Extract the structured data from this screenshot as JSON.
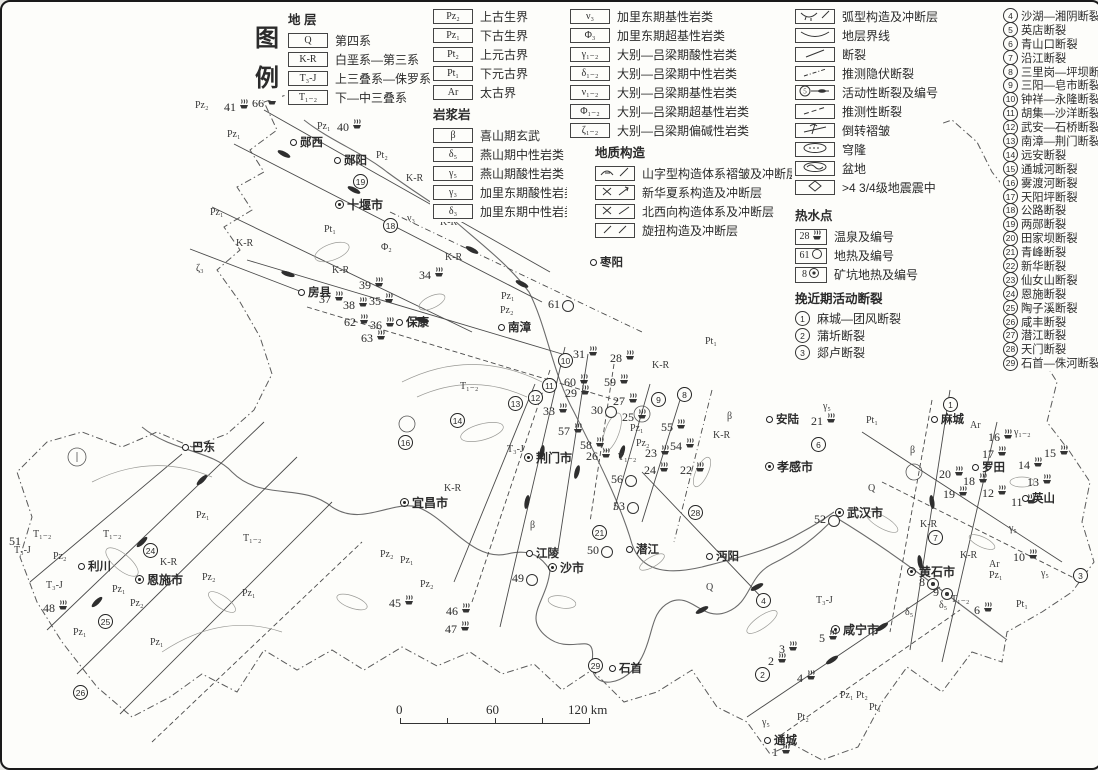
{
  "legend": {
    "title_char1": "图",
    "title_char2": "例",
    "strata_header": "地 层",
    "strata_col1": [
      {
        "code": "Q",
        "label": "第四系"
      },
      {
        "code": "K-R",
        "label": "白垩系—第三系"
      },
      {
        "code": "T₃-J",
        "label": "上三叠系—侏罗系"
      },
      {
        "code": "T₁₋₂",
        "label": "下—中三叠系"
      }
    ],
    "strata_col2": [
      {
        "code": "Pz₂",
        "label": "上古生界"
      },
      {
        "code": "Pz₁",
        "label": "下古生界"
      },
      {
        "code": "Pt₂",
        "label": "上元古界"
      },
      {
        "code": "Pt₁",
        "label": "下元古界"
      },
      {
        "code": "Ar",
        "label": "太古界"
      }
    ],
    "igneous_header": "岩浆岩",
    "igneous_col1": [
      {
        "code": "β",
        "label": "喜山期玄武"
      },
      {
        "code": "δ₅",
        "label": "燕山期中性岩类"
      },
      {
        "code": "γ₅",
        "label": "燕山期酸性岩类"
      },
      {
        "code": "γ₃",
        "label": "加里东期酸性岩类"
      },
      {
        "code": "δ₃",
        "label": "加里东期中性岩类"
      }
    ],
    "igneous_col2": [
      {
        "code": "ν₃",
        "label": "加里东期基性岩类"
      },
      {
        "code": "Φ₃",
        "label": "加里东期超基性岩类"
      },
      {
        "code": "γ₁₋₂",
        "label": "大别—吕梁期酸性岩类"
      },
      {
        "code": "δ₁₋₂",
        "label": "大别—吕梁期中性岩类"
      },
      {
        "code": "ν₁₋₂",
        "label": "大别—吕梁期基性岩类"
      },
      {
        "code": "Φ₁₋₂",
        "label": "大别—吕梁期超基性岩类"
      },
      {
        "code": "ζ₁₋₂",
        "label": "大别—吕梁期偏碱性岩类"
      }
    ],
    "structure_header": "地质构造",
    "structure_items": [
      {
        "icon": "mountain-fold-icon",
        "label": "山字型构造体系褶皱及冲断层"
      },
      {
        "icon": "neocathaysian-icon",
        "label": "新华夏系构造及冲断层"
      },
      {
        "icon": "nw-structure-icon",
        "label": "北西向构造体系及冲断层"
      },
      {
        "icon": "rotational-icon",
        "label": "旋扭构造及冲断层"
      }
    ],
    "symbol_items": [
      {
        "icon": "arc-fold-icon",
        "label": "弧型构造及冲断层"
      },
      {
        "icon": "boundary-icon",
        "label": "地层界线"
      },
      {
        "icon": "fault-icon",
        "label": "断裂"
      },
      {
        "icon": "inferred-buried-fault-icon",
        "label": "推测隐伏断裂"
      },
      {
        "icon": "active-fault-icon",
        "label": "活动性断裂及编号"
      },
      {
        "icon": "inferred-fault-icon",
        "label": "推测性断裂"
      },
      {
        "icon": "overturned-fold-icon",
        "label": "倒转褶皱"
      },
      {
        "icon": "dome-icon",
        "label": "穹隆"
      },
      {
        "icon": "basin-icon",
        "label": "盆地"
      },
      {
        "icon": "epicenter-icon",
        "label": ">4 3/4级地震震中"
      }
    ],
    "hotwater_header": "热水点",
    "hotwater_items": [
      {
        "box": "28",
        "icon": "hot-spring-icon",
        "label": "温泉及编号"
      },
      {
        "box": "61",
        "icon": "geothermal-icon",
        "label": "地热及编号"
      },
      {
        "box": "8",
        "icon": "mine-geothermal-icon",
        "label": "矿坑地热及编号"
      }
    ],
    "active_header": "挽近期活动断裂",
    "active_items": [
      {
        "num": "1",
        "label": "麻城—团风断裂"
      },
      {
        "num": "2",
        "label": "蒲圻断裂"
      },
      {
        "num": "3",
        "label": "郯卢断裂"
      }
    ],
    "numbered_faults": [
      {
        "num": "4",
        "label": "沙湖—湘阴断裂"
      },
      {
        "num": "5",
        "label": "英店断裂"
      },
      {
        "num": "6",
        "label": "青山口断裂"
      },
      {
        "num": "7",
        "label": "沿江断裂"
      },
      {
        "num": "8",
        "label": "三里岗—坪坝断裂"
      },
      {
        "num": "9",
        "label": "三阳—皂市断裂"
      },
      {
        "num": "10",
        "label": "钟祥—永隆断裂"
      },
      {
        "num": "11",
        "label": "胡集—沙洋断裂"
      },
      {
        "num": "12",
        "label": "武安—石桥断裂"
      },
      {
        "num": "13",
        "label": "南漳—荆门断裂"
      },
      {
        "num": "14",
        "label": "远安断裂"
      },
      {
        "num": "15",
        "label": "通城河断裂"
      },
      {
        "num": "16",
        "label": "雾渡河断裂"
      },
      {
        "num": "17",
        "label": "天阳坪断裂"
      },
      {
        "num": "18",
        "label": "公路断裂"
      },
      {
        "num": "19",
        "label": "两郧断裂"
      },
      {
        "num": "20",
        "label": "田家坝断裂"
      },
      {
        "num": "21",
        "label": "青峰断裂"
      },
      {
        "num": "22",
        "label": "新华断裂"
      },
      {
        "num": "23",
        "label": "仙女山断裂"
      },
      {
        "num": "24",
        "label": "恩施断裂"
      },
      {
        "num": "25",
        "label": "陶子溪断裂"
      },
      {
        "num": "26",
        "label": "咸丰断裂"
      },
      {
        "num": "27",
        "label": "潜江断裂"
      },
      {
        "num": "28",
        "label": "天门断裂"
      },
      {
        "num": "29",
        "label": "石首—侏河断裂"
      }
    ]
  },
  "scalebar": {
    "left": "0",
    "mid": "60",
    "right": "120 km"
  },
  "map": {
    "cities": [
      {
        "n": "十堰市",
        "x": 333,
        "y": 200,
        "t": "major"
      },
      {
        "n": "襄樊市",
        "x": 815,
        "y": 288,
        "t": "major"
      },
      {
        "n": "荆门市",
        "x": 522,
        "y": 453,
        "t": "major"
      },
      {
        "n": "宜昌市",
        "x": 398,
        "y": 498,
        "t": "major"
      },
      {
        "n": "沙市",
        "x": 546,
        "y": 563,
        "t": "major"
      },
      {
        "n": "孝感市",
        "x": 763,
        "y": 462,
        "t": "major"
      },
      {
        "n": "武汉市",
        "x": 833,
        "y": 508,
        "t": "major"
      },
      {
        "n": "恩施市",
        "x": 133,
        "y": 575,
        "t": "major"
      },
      {
        "n": "咸宁市",
        "x": 829,
        "y": 625,
        "t": "major"
      },
      {
        "n": "黄石市",
        "x": 905,
        "y": 567,
        "t": "major"
      },
      {
        "n": "郧西",
        "x": 288,
        "y": 138,
        "t": "town"
      },
      {
        "n": "郧阳",
        "x": 332,
        "y": 156,
        "t": "town"
      },
      {
        "n": "均县",
        "x": 438,
        "y": 210,
        "t": "town"
      },
      {
        "n": "房县",
        "x": 296,
        "y": 288,
        "t": "town"
      },
      {
        "n": "保康",
        "x": 394,
        "y": 318,
        "t": "town"
      },
      {
        "n": "南漳",
        "x": 496,
        "y": 323,
        "t": "town"
      },
      {
        "n": "枣阳",
        "x": 588,
        "y": 258,
        "t": "town"
      },
      {
        "n": "安陆",
        "x": 764,
        "y": 415,
        "t": "town"
      },
      {
        "n": "麻城",
        "x": 929,
        "y": 415,
        "t": "town"
      },
      {
        "n": "罗田",
        "x": 970,
        "y": 463,
        "t": "town"
      },
      {
        "n": "英山",
        "x": 1020,
        "y": 494,
        "t": "town"
      },
      {
        "n": "江陵",
        "x": 524,
        "y": 549,
        "t": "town"
      },
      {
        "n": "潜江",
        "x": 624,
        "y": 545,
        "t": "town"
      },
      {
        "n": "沔阳",
        "x": 704,
        "y": 552,
        "t": "town"
      },
      {
        "n": "利川",
        "x": 76,
        "y": 562,
        "t": "town"
      },
      {
        "n": "巴东",
        "x": 180,
        "y": 443,
        "t": "town"
      },
      {
        "n": "通城",
        "x": 762,
        "y": 736,
        "t": "town"
      },
      {
        "n": "石首",
        "x": 607,
        "y": 664,
        "t": "town"
      }
    ],
    "springs": [
      {
        "n": "41",
        "x": 228,
        "y": 103,
        "t": "s"
      },
      {
        "n": "66",
        "x": 256,
        "y": 99,
        "t": "s"
      },
      {
        "n": "40",
        "x": 341,
        "y": 123,
        "t": "s"
      },
      {
        "n": "34",
        "x": 423,
        "y": 271,
        "t": "s"
      },
      {
        "n": "39",
        "x": 363,
        "y": 281,
        "t": "s"
      },
      {
        "n": "37",
        "x": 323,
        "y": 295,
        "t": "s"
      },
      {
        "n": "38",
        "x": 347,
        "y": 301,
        "t": "s"
      },
      {
        "n": "35",
        "x": 373,
        "y": 297,
        "t": "s"
      },
      {
        "n": "62",
        "x": 348,
        "y": 318,
        "t": "s"
      },
      {
        "n": "36",
        "x": 374,
        "y": 321,
        "t": "s"
      },
      {
        "n": "63",
        "x": 365,
        "y": 334,
        "t": "s"
      },
      {
        "n": "61",
        "x": 552,
        "y": 303,
        "t": "c"
      },
      {
        "n": "31",
        "x": 577,
        "y": 350,
        "t": "s"
      },
      {
        "n": "28",
        "x": 614,
        "y": 354,
        "t": "s"
      },
      {
        "n": "60",
        "x": 568,
        "y": 378,
        "t": "s"
      },
      {
        "n": "59",
        "x": 608,
        "y": 378,
        "t": "s"
      },
      {
        "n": "29",
        "x": 569,
        "y": 389,
        "t": "s"
      },
      {
        "n": "27",
        "x": 617,
        "y": 397,
        "t": "s"
      },
      {
        "n": "30",
        "x": 595,
        "y": 409,
        "t": "c"
      },
      {
        "n": "33",
        "x": 547,
        "y": 407,
        "t": "s"
      },
      {
        "n": "57",
        "x": 562,
        "y": 427,
        "t": "s"
      },
      {
        "n": "58",
        "x": 584,
        "y": 441,
        "t": "s"
      },
      {
        "n": "26",
        "x": 590,
        "y": 452,
        "t": "s"
      },
      {
        "n": "25",
        "x": 626,
        "y": 413,
        "t": "s"
      },
      {
        "n": "55",
        "x": 665,
        "y": 423,
        "t": "s"
      },
      {
        "n": "54",
        "x": 674,
        "y": 442,
        "t": "s"
      },
      {
        "n": "23",
        "x": 649,
        "y": 449,
        "t": "s"
      },
      {
        "n": "24",
        "x": 648,
        "y": 466,
        "t": "s"
      },
      {
        "n": "22",
        "x": 684,
        "y": 466,
        "t": "s"
      },
      {
        "n": "56",
        "x": 615,
        "y": 478,
        "t": "c"
      },
      {
        "n": "53",
        "x": 617,
        "y": 505,
        "t": "c"
      },
      {
        "n": "52",
        "x": 818,
        "y": 518,
        "t": "c"
      },
      {
        "n": "50",
        "x": 591,
        "y": 549,
        "t": "c"
      },
      {
        "n": "49",
        "x": 516,
        "y": 577,
        "t": "c"
      },
      {
        "n": "45",
        "x": 393,
        "y": 599,
        "t": "s"
      },
      {
        "n": "46",
        "x": 450,
        "y": 607,
        "t": "s"
      },
      {
        "n": "47",
        "x": 449,
        "y": 625,
        "t": "s"
      },
      {
        "n": "48",
        "x": 47,
        "y": 604,
        "t": "s"
      },
      {
        "n": "51",
        "x": 13,
        "y": 540,
        "t": "n"
      },
      {
        "n": "21",
        "x": 815,
        "y": 417,
        "t": "s"
      },
      {
        "n": "20",
        "x": 943,
        "y": 470,
        "t": "s"
      },
      {
        "n": "19",
        "x": 947,
        "y": 490,
        "t": "s"
      },
      {
        "n": "18",
        "x": 967,
        "y": 477,
        "t": "s"
      },
      {
        "n": "17",
        "x": 986,
        "y": 450,
        "t": "s"
      },
      {
        "n": "16",
        "x": 992,
        "y": 433,
        "t": "s"
      },
      {
        "n": "15",
        "x": 1048,
        "y": 449,
        "t": "s"
      },
      {
        "n": "14",
        "x": 1022,
        "y": 461,
        "t": "s"
      },
      {
        "n": "13",
        "x": 1031,
        "y": 478,
        "t": "s"
      },
      {
        "n": "12",
        "x": 986,
        "y": 489,
        "t": "s"
      },
      {
        "n": "11",
        "x": 1015,
        "y": 498,
        "t": "s"
      },
      {
        "n": "10",
        "x": 1017,
        "y": 553,
        "t": "s"
      },
      {
        "n": "8",
        "x": 923,
        "y": 581,
        "t": "m"
      },
      {
        "n": "9",
        "x": 937,
        "y": 591,
        "t": "m"
      },
      {
        "n": "6",
        "x": 978,
        "y": 606,
        "t": "s"
      },
      {
        "n": "5",
        "x": 823,
        "y": 634,
        "t": "s"
      },
      {
        "n": "4",
        "x": 801,
        "y": 674,
        "t": "s"
      },
      {
        "n": "3",
        "x": 783,
        "y": 645,
        "t": "s"
      },
      {
        "n": "2",
        "x": 772,
        "y": 657,
        "t": "s"
      },
      {
        "n": "1",
        "x": 776,
        "y": 748,
        "t": "s"
      }
    ],
    "circled": [
      {
        "n": "1",
        "x": 948,
        "y": 402
      },
      {
        "n": "2",
        "x": 760,
        "y": 672
      },
      {
        "n": "3",
        "x": 1078,
        "y": 573
      },
      {
        "n": "4",
        "x": 761,
        "y": 598
      },
      {
        "n": "6",
        "x": 816,
        "y": 442
      },
      {
        "n": "7",
        "x": 933,
        "y": 535
      },
      {
        "n": "8",
        "x": 682,
        "y": 392
      },
      {
        "n": "9",
        "x": 656,
        "y": 397
      },
      {
        "n": "10",
        "x": 563,
        "y": 358
      },
      {
        "n": "11",
        "x": 547,
        "y": 383
      },
      {
        "n": "12",
        "x": 533,
        "y": 395
      },
      {
        "n": "13",
        "x": 513,
        "y": 401
      },
      {
        "n": "14",
        "x": 455,
        "y": 418
      },
      {
        "n": "16",
        "x": 403,
        "y": 440
      },
      {
        "n": "18",
        "x": 388,
        "y": 223
      },
      {
        "n": "19",
        "x": 358,
        "y": 179
      },
      {
        "n": "21",
        "x": 597,
        "y": 530
      },
      {
        "n": "24",
        "x": 148,
        "y": 548
      },
      {
        "n": "25",
        "x": 103,
        "y": 619
      },
      {
        "n": "26",
        "x": 78,
        "y": 690
      },
      {
        "n": "28",
        "x": 693,
        "y": 510
      },
      {
        "n": "29",
        "x": 593,
        "y": 663
      }
    ],
    "units": [
      {
        "t": "Pz₂",
        "x": 198,
        "y": 104
      },
      {
        "t": "Pz₁",
        "x": 230,
        "y": 133
      },
      {
        "t": "Pz₁",
        "x": 320,
        "y": 125
      },
      {
        "t": "Pt₂",
        "x": 379,
        "y": 154
      },
      {
        "t": "K-R",
        "x": 409,
        "y": 177
      },
      {
        "t": "K-R",
        "x": 443,
        "y": 221
      },
      {
        "t": "ν₃",
        "x": 410,
        "y": 217
      },
      {
        "t": "Pt₁",
        "x": 327,
        "y": 228
      },
      {
        "t": "Φ₂",
        "x": 384,
        "y": 246
      },
      {
        "t": "Pz₁",
        "x": 213,
        "y": 211
      },
      {
        "t": "K-R",
        "x": 239,
        "y": 242
      },
      {
        "t": "ζ₃",
        "x": 199,
        "y": 267
      },
      {
        "t": "K-R",
        "x": 335,
        "y": 269
      },
      {
        "t": "K-R",
        "x": 448,
        "y": 256
      },
      {
        "t": "Pz₁",
        "x": 504,
        "y": 295
      },
      {
        "t": "Pz₂",
        "x": 503,
        "y": 309
      },
      {
        "t": "Pz₁",
        "x": 633,
        "y": 427
      },
      {
        "t": "Pz₂",
        "x": 639,
        "y": 442
      },
      {
        "t": "T₁₋₂",
        "x": 621,
        "y": 456
      },
      {
        "t": "T₁₋₂",
        "x": 463,
        "y": 385
      },
      {
        "t": "T₃-J",
        "x": 510,
        "y": 448
      },
      {
        "t": "K-R",
        "x": 447,
        "y": 487
      },
      {
        "t": "β",
        "x": 533,
        "y": 524
      },
      {
        "t": "Pz₁",
        "x": 403,
        "y": 559
      },
      {
        "t": "Pz₂",
        "x": 383,
        "y": 553
      },
      {
        "t": "Pz₂",
        "x": 423,
        "y": 583
      },
      {
        "t": "Pt₁",
        "x": 708,
        "y": 340
      },
      {
        "t": "K-R",
        "x": 655,
        "y": 364
      },
      {
        "t": "β",
        "x": 730,
        "y": 415
      },
      {
        "t": "K-R",
        "x": 716,
        "y": 434
      },
      {
        "t": "γ₅",
        "x": 826,
        "y": 405
      },
      {
        "t": "Pt₁",
        "x": 869,
        "y": 419
      },
      {
        "t": "β",
        "x": 913,
        "y": 449
      },
      {
        "t": "Q",
        "x": 709,
        "y": 586
      },
      {
        "t": "T₃-J",
        "x": 819,
        "y": 599
      },
      {
        "t": "K-R",
        "x": 923,
        "y": 523
      },
      {
        "t": "Ar",
        "x": 973,
        "y": 424
      },
      {
        "t": "γ₁₋₂",
        "x": 1017,
        "y": 431
      },
      {
        "t": "γ₅",
        "x": 1012,
        "y": 527
      },
      {
        "t": "γ₅",
        "x": 1044,
        "y": 572
      },
      {
        "t": "K-R",
        "x": 963,
        "y": 554
      },
      {
        "t": "Ar",
        "x": 992,
        "y": 563
      },
      {
        "t": "Pz₁",
        "x": 992,
        "y": 574
      },
      {
        "t": "Pt₁",
        "x": 1019,
        "y": 603
      },
      {
        "t": "T₁₋₂",
        "x": 954,
        "y": 598
      },
      {
        "t": "δ₅",
        "x": 908,
        "y": 611
      },
      {
        "t": "δ₅",
        "x": 942,
        "y": 604
      },
      {
        "t": "γ₅",
        "x": 765,
        "y": 721
      },
      {
        "t": "T₁₋₂",
        "x": 36,
        "y": 533
      },
      {
        "t": "T₃-J",
        "x": 17,
        "y": 549
      },
      {
        "t": "Pz₂",
        "x": 56,
        "y": 555
      },
      {
        "t": "T₁₋₂",
        "x": 106,
        "y": 533
      },
      {
        "t": "T₃-J",
        "x": 49,
        "y": 584
      },
      {
        "t": "Pz₁",
        "x": 115,
        "y": 588
      },
      {
        "t": "Pz₂",
        "x": 133,
        "y": 602
      },
      {
        "t": "Pz₁",
        "x": 199,
        "y": 514
      },
      {
        "t": "K-R",
        "x": 163,
        "y": 561
      },
      {
        "t": "Pz₂",
        "x": 205,
        "y": 576
      },
      {
        "t": "Pz₁",
        "x": 245,
        "y": 592
      },
      {
        "t": "T₁₋₂",
        "x": 246,
        "y": 537
      },
      {
        "t": "Pz₁",
        "x": 76,
        "y": 631
      },
      {
        "t": "Pz₁",
        "x": 153,
        "y": 641
      },
      {
        "t": "Q",
        "x": 871,
        "y": 487
      },
      {
        "t": "Pz₁ Pt₂",
        "x": 843,
        "y": 694
      },
      {
        "t": "Pt₁",
        "x": 872,
        "y": 706
      },
      {
        "t": "Pt₂",
        "x": 800,
        "y": 716
      }
    ]
  }
}
